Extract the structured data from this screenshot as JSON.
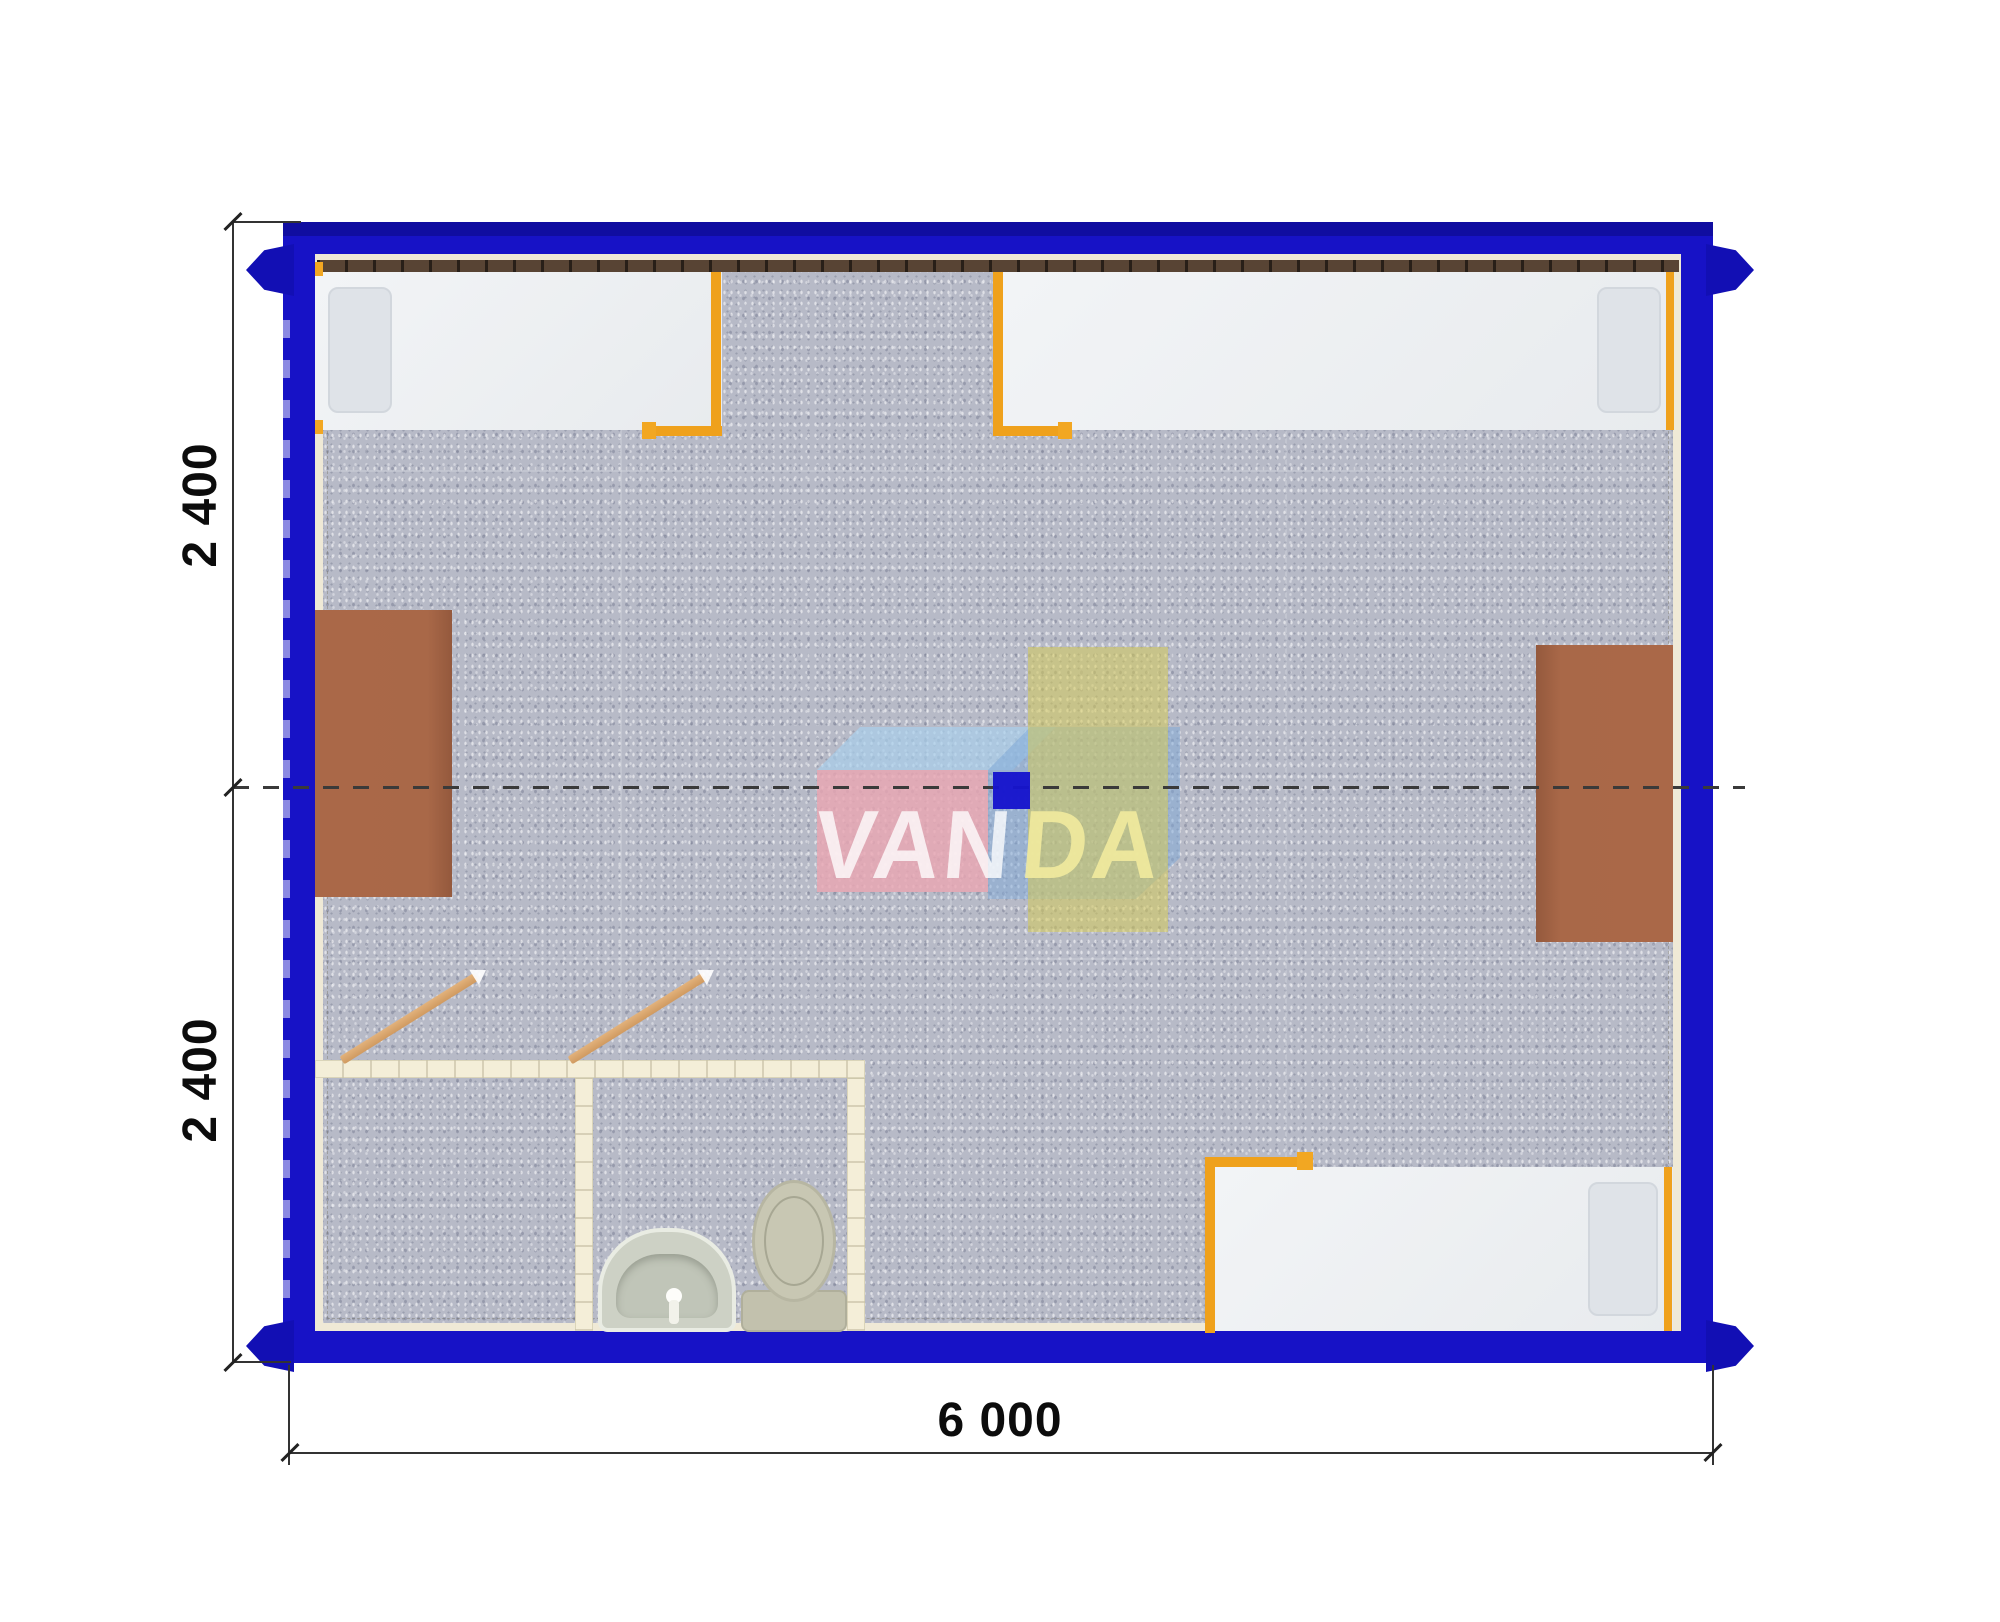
{
  "plan": {
    "type": "floor-plan-top-view",
    "dimension_labels": {
      "upper_height": "2 400",
      "lower_height": "2 400",
      "width": "6 000"
    },
    "watermark": {
      "left": "VAN",
      "right": "DA"
    },
    "colors": {
      "wall_blue": "#1712c6",
      "corner_fitting_blue": "#120fb4",
      "floor_gray": "#b7bac7",
      "liner_cream": "#efe9d6",
      "window_band_brown": "#584434",
      "bed_mattress": "#eef0f3",
      "bed_frame_orange": "#efa11c",
      "desk_brown": "#a96848",
      "center_table_yellow": "#d5cb58",
      "partition_cream": "#f4eed8",
      "door_leaf_tan": "#d9a878",
      "logo_pink": "#e9a6b2",
      "logo_light_blue": "#a8cdeb",
      "logo_steel_blue": "#7ea8d8",
      "logo_square_blue": "#1614cd",
      "dimension_line": "#333333"
    },
    "rooms": {
      "fixtures": [
        "bed",
        "bed",
        "bed",
        "desk",
        "desk",
        "table",
        "sink",
        "toilet"
      ]
    }
  }
}
